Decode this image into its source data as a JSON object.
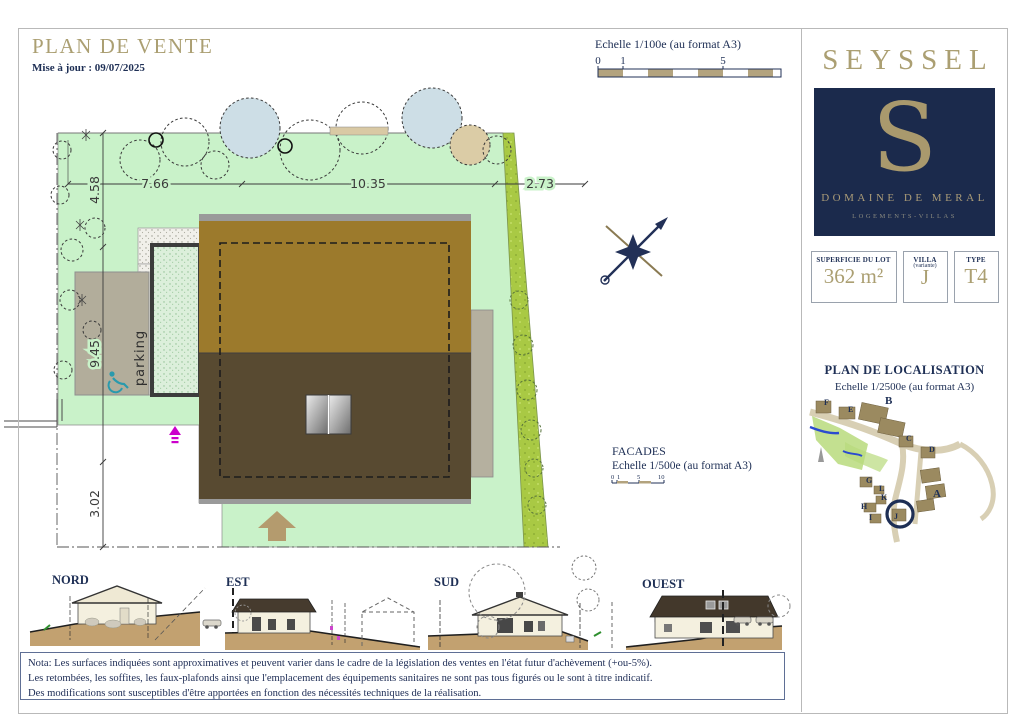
{
  "header": {
    "title": "PLAN DE VENTE",
    "updated": "Mise à jour : 09/07/2025"
  },
  "main_scale": {
    "label": "Echelle 1/100e (au format A3)",
    "ticks": [
      "0",
      "1",
      "5"
    ]
  },
  "site_plan": {
    "dims_top": [
      "7.66",
      "10.35",
      "2.73"
    ],
    "dims_left": [
      "4.58",
      "9.45",
      "3.02"
    ],
    "parking_label": "parking"
  },
  "facades": {
    "title": "FACADES",
    "scale": "Echelle 1/500e (au format A3)",
    "ticks": [
      "0",
      "1",
      "5",
      "10"
    ],
    "elevations": [
      "NORD",
      "EST",
      "SUD",
      "OUEST"
    ]
  },
  "note": {
    "line1": "Nota: Les surfaces indiquées sont approximatives et peuvent varier dans le cadre de la législation des ventes en l'état futur d'achèvement (+ou-5%).",
    "line2": "Les retombées, les soffites, les faux-plafonds ainsi que l'emplacement des équipements sanitaires ne sont pas tous figurés ou le sont à titre indicatif.",
    "line3": "Des modifications sont susceptibles d'être apportées en fonction des nécessités techniques de la réalisation."
  },
  "panel": {
    "city": "SEYSSEL",
    "logo": {
      "letter": "S",
      "name": "DOMAINE DE MERAL",
      "tagline": "LOGEMENTS-VILLAS"
    },
    "info": [
      {
        "label": "SUPERFICIE DU LOT",
        "value": "362 m²"
      },
      {
        "label": "VILLA",
        "sublabel": "(variante)",
        "value": "J"
      },
      {
        "label": "TYPE",
        "value": "T4"
      }
    ],
    "localisation": {
      "title": "PLAN DE LOCALISATION",
      "scale": "Echelle 1/2500e (au format A3)",
      "lots": [
        "F",
        "E",
        "B",
        "C",
        "D",
        "G",
        "L",
        "K",
        "H",
        "I",
        "J",
        "A"
      ],
      "highlighted_lot": "J"
    }
  },
  "colors": {
    "gold": "#ab9f72",
    "navy": "#1e2f55",
    "lawn": "#c9f2c9",
    "hedge": "#a9c944",
    "roof_upper": "#9c7a2c",
    "roof_lower": "#584a31",
    "parking": "#b2ad9b",
    "ground": "#c2a170",
    "accent_teal": "#2a9aad",
    "marker_magenta": "#cc00cc"
  }
}
